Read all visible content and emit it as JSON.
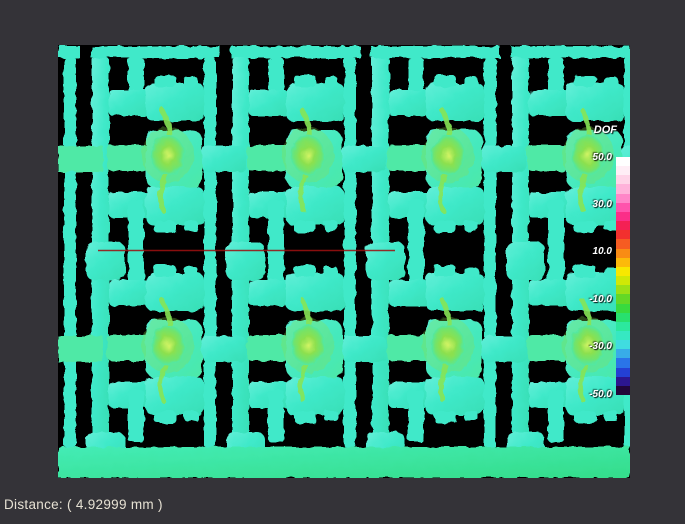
{
  "window": {
    "bg_color": "#343338"
  },
  "heatmap": {
    "bg_color": "#000000",
    "material_color": "#3fe9c9",
    "material_light": "#63efd8",
    "material_green": "#4fe9a6",
    "hotspot_color": "#8ce04e",
    "hotspot_core": "#d2f464",
    "bottom_band_color": "#3ae9a8",
    "measure_line_color": "#9c1111"
  },
  "legend": {
    "title": "DOF",
    "ticks": [
      "50.0",
      "30.0",
      "10.0",
      "-10.0",
      "-30.0",
      "-50.0"
    ],
    "colorbar_colors": [
      "#ffffff",
      "#ffeef6",
      "#ffd4e8",
      "#ffb2da",
      "#ff86c8",
      "#ff54ac",
      "#fb2e88",
      "#f42054",
      "#f2302e",
      "#f65c22",
      "#f98c14",
      "#fcba0a",
      "#f8e800",
      "#d0e806",
      "#9ce016",
      "#64d826",
      "#38da3e",
      "#28e06e",
      "#2ce89e",
      "#36e8c2",
      "#40dce0",
      "#38ace8",
      "#2a74e8",
      "#2440d4",
      "#2c1690",
      "#22063a"
    ]
  },
  "status_bar": {
    "distance_text": "Distance: ( 4.92999 mm )"
  }
}
